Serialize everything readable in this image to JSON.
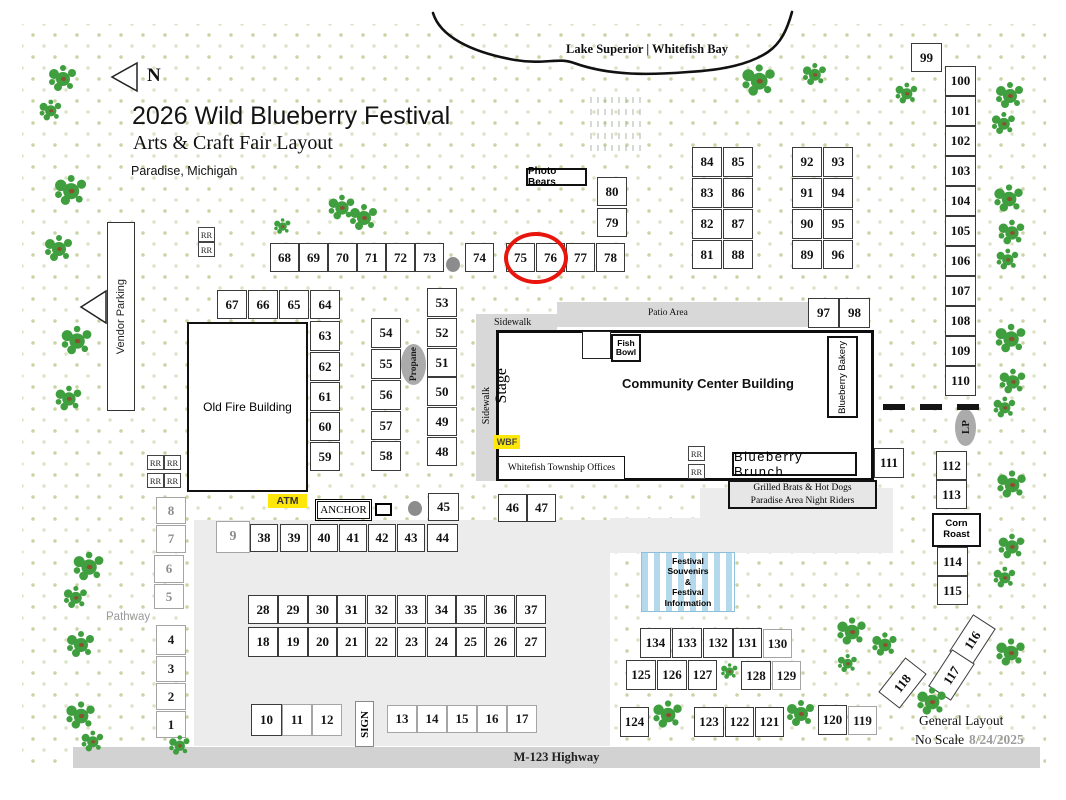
{
  "header": {
    "north": "N",
    "title": "2026 Wild Blueberry Festival",
    "subtitle": "Arts & Craft Fair Layout",
    "location": "Paradise, Michigan"
  },
  "map": {
    "lake_label": "Lake Superior | Whitefish Bay",
    "highway": "M-123 Highway",
    "pathway": "Pathway",
    "patio": "Patio Area",
    "sidewalk_top": "Sidewalk",
    "sidewalk_side": "Sidewalk",
    "vendor_parking": "Vendor Parking"
  },
  "buildings": {
    "old_fire": "Old Fire Building",
    "community_center": "Community Center Building",
    "township": "Whitefish Township Offices",
    "stage": "Stage",
    "fish_bowl_line1": "Fish",
    "fish_bowl_line2": "Bowl",
    "bakery": "Blueberry Bakery",
    "brunch": "Blueberry Brunch",
    "wbf": "WBF"
  },
  "stands": {
    "photo_bears": "Photo Bears",
    "atm": "ATM",
    "anchor": "ANCHOR",
    "sign": "SIGN",
    "propane": "Propane",
    "lp": "LP",
    "corn_roast_line1": "Corn",
    "corn_roast_line2": "Roast",
    "brats_line1": "Grilled Brats & Hot Dogs",
    "brats_line2": "Paradise Area Night Riders",
    "tent_lines": [
      "Festival",
      "Souvenirs",
      "&",
      "Festival",
      "Information"
    ]
  },
  "restroom": "RR",
  "footer": {
    "general_layout": "General Layout",
    "no_scale": "No Scale",
    "date": "8/24/2025"
  },
  "highlight": {
    "circled_booths": "75, 76",
    "color": "#e8150c"
  },
  "booths": [
    [
      "68",
      270,
      243,
      29,
      29
    ],
    [
      "69",
      299,
      243,
      29,
      29
    ],
    [
      "70",
      328,
      243,
      29,
      29
    ],
    [
      "71",
      357,
      243,
      29,
      29
    ],
    [
      "72",
      386,
      243,
      29,
      29
    ],
    [
      "73",
      415,
      243,
      29,
      29
    ],
    [
      "74",
      465,
      243,
      29,
      29
    ],
    [
      "75",
      506,
      243,
      29,
      29
    ],
    [
      "76",
      536,
      243,
      29,
      29
    ],
    [
      "77",
      566,
      243,
      29,
      29
    ],
    [
      "78",
      596,
      243,
      29,
      29
    ],
    [
      "79",
      597,
      208,
      30,
      29
    ],
    [
      "80",
      597,
      177,
      30,
      29
    ],
    [
      "84",
      692,
      147,
      30,
      30
    ],
    [
      "85",
      723,
      147,
      30,
      30
    ],
    [
      "83",
      692,
      178,
      30,
      30
    ],
    [
      "86",
      723,
      178,
      30,
      30
    ],
    [
      "82",
      692,
      209,
      30,
      30
    ],
    [
      "87",
      723,
      209,
      30,
      30
    ],
    [
      "81",
      692,
      240,
      30,
      29
    ],
    [
      "88",
      723,
      240,
      30,
      29
    ],
    [
      "92",
      792,
      147,
      30,
      30
    ],
    [
      "93",
      823,
      147,
      30,
      30
    ],
    [
      "91",
      792,
      178,
      30,
      30
    ],
    [
      "94",
      823,
      178,
      30,
      30
    ],
    [
      "90",
      792,
      209,
      30,
      30
    ],
    [
      "95",
      823,
      209,
      30,
      30
    ],
    [
      "89",
      792,
      240,
      30,
      29
    ],
    [
      "96",
      823,
      240,
      30,
      29
    ],
    [
      "97",
      808,
      298,
      31,
      30
    ],
    [
      "98",
      839,
      298,
      31,
      30
    ],
    [
      "99",
      911,
      43,
      31,
      29
    ],
    [
      "100",
      945,
      66,
      31,
      30
    ],
    [
      "101",
      945,
      96,
      31,
      30
    ],
    [
      "102",
      945,
      126,
      31,
      30
    ],
    [
      "103",
      945,
      156,
      31,
      30
    ],
    [
      "104",
      945,
      186,
      31,
      30
    ],
    [
      "105",
      945,
      216,
      31,
      30
    ],
    [
      "106",
      945,
      246,
      31,
      30
    ],
    [
      "107",
      945,
      276,
      31,
      30
    ],
    [
      "108",
      945,
      306,
      31,
      30
    ],
    [
      "109",
      945,
      336,
      31,
      30
    ],
    [
      "110",
      945,
      366,
      31,
      30
    ],
    [
      "67",
      217,
      290,
      30,
      29
    ],
    [
      "66",
      248,
      290,
      30,
      29
    ],
    [
      "65",
      279,
      290,
      30,
      29
    ],
    [
      "64",
      310,
      290,
      30,
      29
    ],
    [
      "63",
      310,
      321,
      30,
      30
    ],
    [
      "62",
      310,
      352,
      30,
      29
    ],
    [
      "61",
      310,
      382,
      30,
      29
    ],
    [
      "60",
      310,
      412,
      30,
      29
    ],
    [
      "59",
      310,
      442,
      30,
      29
    ],
    [
      "54",
      371,
      318,
      30,
      30
    ],
    [
      "55",
      371,
      349,
      30,
      30
    ],
    [
      "56",
      371,
      380,
      30,
      30
    ],
    [
      "57",
      371,
      411,
      30,
      29
    ],
    [
      "58",
      371,
      441,
      30,
      30
    ],
    [
      "53",
      427,
      288,
      30,
      29
    ],
    [
      "52",
      427,
      318,
      30,
      29
    ],
    [
      "51",
      427,
      348,
      30,
      29
    ],
    [
      "50",
      427,
      377,
      30,
      29
    ],
    [
      "49",
      427,
      407,
      30,
      29
    ],
    [
      "48",
      427,
      437,
      30,
      29
    ],
    [
      "8",
      156,
      497,
      30,
      27,
      "lt"
    ],
    [
      "7",
      156,
      525,
      30,
      28,
      "lt"
    ],
    [
      "6",
      154,
      555,
      30,
      28,
      "lt"
    ],
    [
      "5",
      154,
      584,
      30,
      25,
      "lt"
    ],
    [
      "4",
      156,
      625,
      30,
      30,
      "lb"
    ],
    [
      "3",
      156,
      656,
      30,
      26,
      "lb"
    ],
    [
      "2",
      156,
      683,
      30,
      27,
      "lb"
    ],
    [
      "1",
      156,
      711,
      30,
      27,
      "lb"
    ],
    [
      "9",
      216,
      521,
      34,
      32,
      "lt big"
    ],
    [
      "38",
      250,
      524,
      28,
      28
    ],
    [
      "39",
      280,
      524,
      28,
      28
    ],
    [
      "40",
      310,
      524,
      28,
      28
    ],
    [
      "41",
      339,
      524,
      28,
      28
    ],
    [
      "42",
      368,
      524,
      28,
      28
    ],
    [
      "43",
      397,
      524,
      28,
      28
    ],
    [
      "44",
      427,
      524,
      31,
      28
    ],
    [
      "45",
      428,
      493,
      31,
      28
    ],
    [
      "46",
      498,
      494,
      29,
      28
    ],
    [
      "47",
      527,
      494,
      29,
      28
    ],
    [
      "28",
      248,
      595,
      30,
      29
    ],
    [
      "29",
      278,
      595,
      30,
      29
    ],
    [
      "30",
      308,
      595,
      29,
      29
    ],
    [
      "31",
      337,
      595,
      29,
      29
    ],
    [
      "32",
      367,
      595,
      29,
      29
    ],
    [
      "33",
      397,
      595,
      29,
      29
    ],
    [
      "34",
      427,
      595,
      29,
      29
    ],
    [
      "35",
      456,
      595,
      29,
      29
    ],
    [
      "36",
      486,
      595,
      29,
      29
    ],
    [
      "37",
      516,
      595,
      30,
      29
    ],
    [
      "18",
      248,
      627,
      30,
      30
    ],
    [
      "19",
      278,
      627,
      30,
      30
    ],
    [
      "20",
      308,
      627,
      29,
      30
    ],
    [
      "21",
      337,
      627,
      29,
      30
    ],
    [
      "22",
      367,
      627,
      29,
      30
    ],
    [
      "23",
      397,
      627,
      29,
      30
    ],
    [
      "24",
      427,
      627,
      29,
      30
    ],
    [
      "25",
      456,
      627,
      29,
      30
    ],
    [
      "26",
      486,
      627,
      29,
      30
    ],
    [
      "27",
      516,
      627,
      30,
      30
    ],
    [
      "10",
      251,
      704,
      31,
      32
    ],
    [
      "11",
      282,
      704,
      30,
      32,
      "lb"
    ],
    [
      "12",
      312,
      704,
      30,
      32,
      "lb"
    ],
    [
      "13",
      387,
      705,
      30,
      28,
      "lb"
    ],
    [
      "14",
      417,
      705,
      30,
      28,
      "lb"
    ],
    [
      "15",
      447,
      705,
      30,
      28,
      "lb"
    ],
    [
      "16",
      477,
      705,
      30,
      28,
      "lb"
    ],
    [
      "17",
      507,
      705,
      30,
      28,
      "lb"
    ],
    [
      "111",
      874,
      448,
      30,
      30
    ],
    [
      "112",
      936,
      451,
      31,
      29
    ],
    [
      "113",
      936,
      480,
      31,
      29
    ],
    [
      "114",
      937,
      547,
      31,
      29
    ],
    [
      "115",
      937,
      576,
      31,
      29
    ],
    [
      "134",
      640,
      628,
      31,
      30
    ],
    [
      "133",
      672,
      628,
      30,
      30
    ],
    [
      "132",
      703,
      628,
      30,
      30
    ],
    [
      "131",
      733,
      628,
      29,
      30
    ],
    [
      "130",
      763,
      629,
      29,
      29,
      "lb"
    ],
    [
      "125",
      626,
      660,
      30,
      30
    ],
    [
      "126",
      657,
      660,
      30,
      30
    ],
    [
      "127",
      688,
      660,
      29,
      30
    ],
    [
      "128",
      741,
      661,
      30,
      29
    ],
    [
      "129",
      772,
      661,
      29,
      29,
      "lb"
    ],
    [
      "124",
      620,
      707,
      29,
      30
    ],
    [
      "123",
      694,
      707,
      30,
      30
    ],
    [
      "122",
      725,
      707,
      29,
      30
    ],
    [
      "121",
      755,
      707,
      29,
      30
    ],
    [
      "120",
      818,
      705,
      29,
      30
    ],
    [
      "119",
      848,
      706,
      29,
      29,
      "lb"
    ],
    [
      "116",
      959,
      618,
      27,
      44,
      "rot33"
    ],
    [
      "117",
      938,
      653,
      27,
      44,
      "rot33"
    ],
    [
      "118",
      889,
      661,
      27,
      44,
      "rot38"
    ]
  ]
}
